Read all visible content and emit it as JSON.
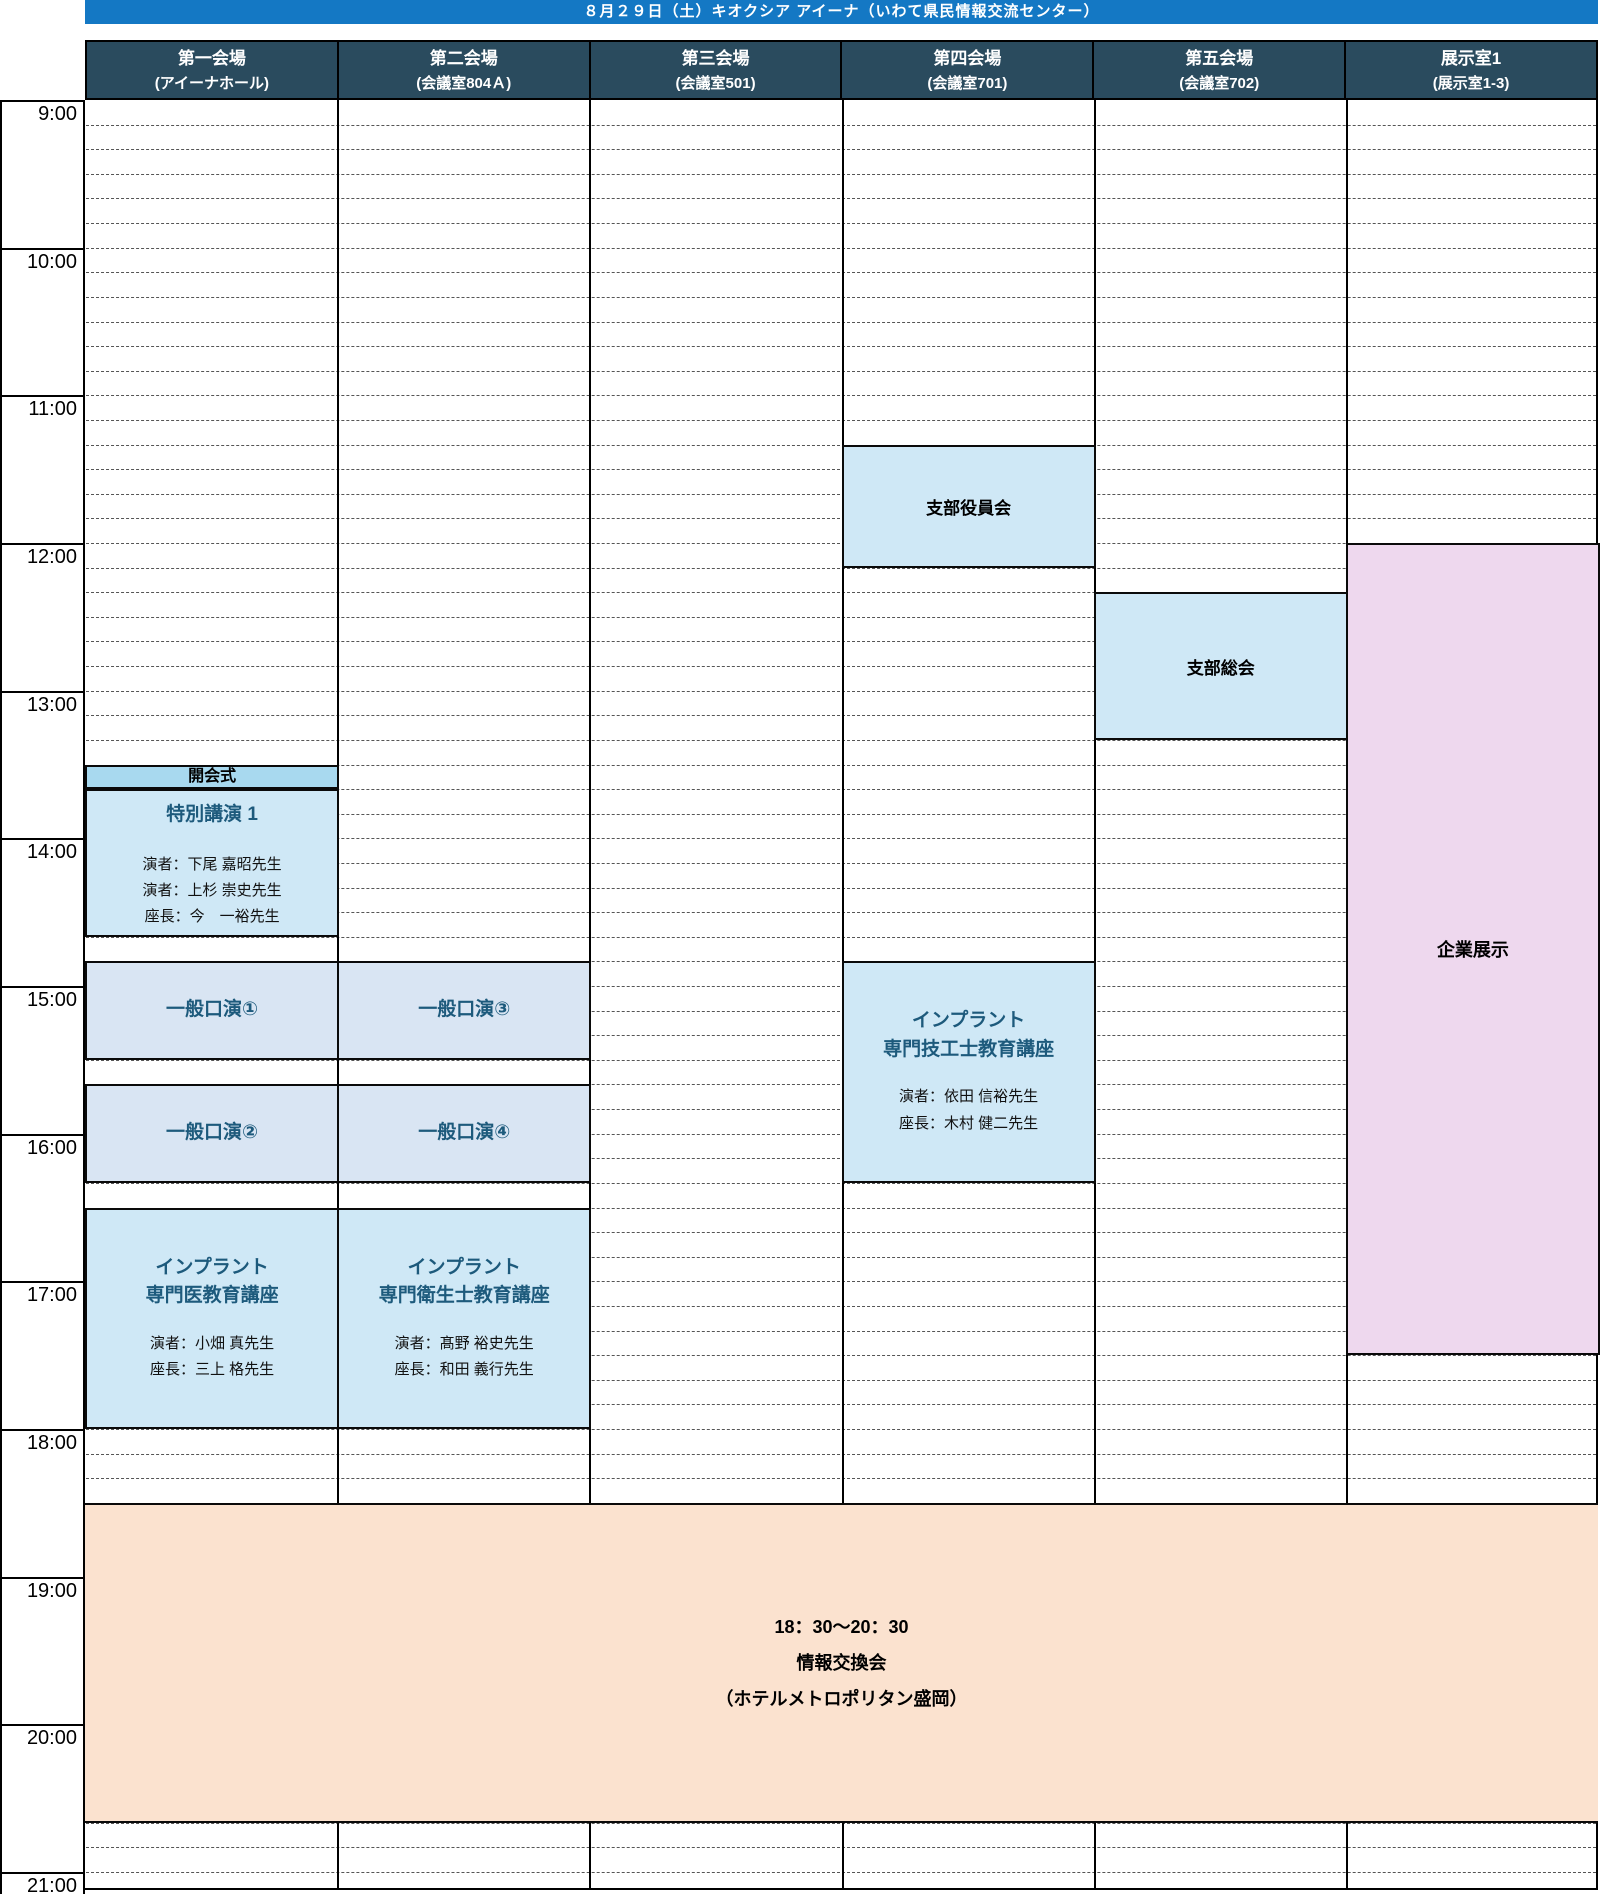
{
  "banner": {
    "title": "８月２９日（土）キオクシア アイーナ（いわて県民情報交流センター）"
  },
  "venues": [
    {
      "name": "第一会場",
      "room": "(アイーナホール)"
    },
    {
      "name": "第二会場",
      "room": "(会議室804Ａ)"
    },
    {
      "name": "第三会場",
      "room": "(会議室501)"
    },
    {
      "name": "第四会場",
      "room": "(会議室701)"
    },
    {
      "name": "第五会場",
      "room": "(会議室702)"
    },
    {
      "name": "展示室1",
      "room": "(展示室1-3)"
    }
  ],
  "time_axis": {
    "start": "9:00",
    "end": "21:00",
    "minor_interval_minutes": 10,
    "hours": [
      "9:00",
      "10:00",
      "11:00",
      "12:00",
      "13:00",
      "14:00",
      "15:00",
      "16:00",
      "17:00",
      "18:00",
      "19:00",
      "20:00",
      "21:00"
    ]
  },
  "events": {
    "shibu_yakuin": {
      "title": "支部役員会",
      "venue": 3,
      "start": "11:20",
      "end": "12:10"
    },
    "shibu_sokai": {
      "title": "支部総会",
      "venue": 4,
      "start": "12:20",
      "end": "13:20"
    },
    "kigyo_tenji": {
      "title": "企業展示",
      "venue": 5,
      "start": "12:00",
      "end": "17:30"
    },
    "kaikaishiki": {
      "title": "開会式",
      "venue": 0,
      "start": "13:30",
      "end": "13:40"
    },
    "tokubetsu_koen1": {
      "title": "特別講演 1",
      "venue": 0,
      "start": "13:40",
      "end": "14:40",
      "speakers": [
        "演者：下尾 嘉昭先生",
        "演者：上杉 崇史先生",
        "座長：今　一裕先生"
      ]
    },
    "ippan_koen1": {
      "title": "一般口演①",
      "venue": 0,
      "start": "14:50",
      "end": "15:30"
    },
    "ippan_koen3": {
      "title": "一般口演③",
      "venue": 1,
      "start": "14:50",
      "end": "15:30"
    },
    "ippan_koen2": {
      "title": "一般口演②",
      "venue": 0,
      "start": "15:40",
      "end": "16:20"
    },
    "ippan_koen4": {
      "title": "一般口演④",
      "venue": 1,
      "start": "15:40",
      "end": "16:20"
    },
    "implant_gikoshi": {
      "title_line1": "インプラント",
      "title_line2": "専門技工士教育講座",
      "venue": 3,
      "start": "14:50",
      "end": "16:20",
      "speakers": [
        "演者：依田 信裕先生",
        "座長：木村 健二先生"
      ]
    },
    "implant_senmon_i": {
      "title_line1": "インプラント",
      "title_line2": "専門医教育講座",
      "venue": 0,
      "start": "16:30",
      "end": "18:00",
      "speakers": [
        "演者：小畑 真先生",
        "座長：三上 格先生"
      ]
    },
    "implant_eiseishi": {
      "title_line1": "インプラント",
      "title_line2": "専門衛生士教育講座",
      "venue": 1,
      "start": "16:30",
      "end": "18:00",
      "speakers": [
        "演者：髙野 裕史先生",
        "座長：和田 義行先生"
      ]
    },
    "joho_kokankai": {
      "time_label": "18：30〜20：30",
      "title": "情報交換会",
      "place": "（ホテルメトロポリタン盛岡）",
      "venue_span": "all",
      "start": "18:30",
      "end": "20:40"
    }
  },
  "colors": {
    "banner": "#1478c4",
    "header_bg": "#2a4b5e",
    "event_blue": "#cfe8f6",
    "event_periwinkle": "#d9e5f3",
    "opening_strip": "#a8d9ef",
    "exhibition_pink": "#eed8ee",
    "gathering_peach": "#fbe2cf",
    "title_teal": "#1d5a7c",
    "grid_dash": "#555555"
  }
}
